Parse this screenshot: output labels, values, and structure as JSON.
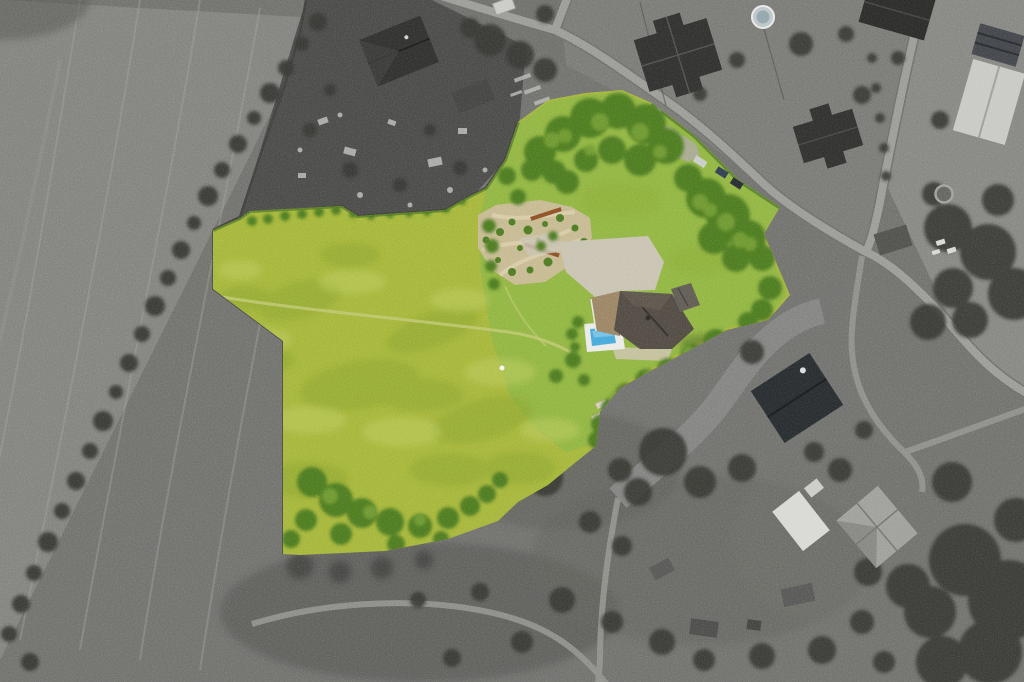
{
  "scene": {
    "type": "aerial-drone-photograph",
    "treatment": "property plot shown in color, all surroundings desaturated to grayscale",
    "subject": "rural residential plot with house, pool, gardens and large meadow"
  },
  "palette": {
    "base_gray": "#6c6c69",
    "field_gray_light": "#7e7e7a",
    "yard_gray_dark": "#454543",
    "plots_gray": "#757571",
    "right_gray": "#82827e",
    "allotment_gray": "#6a6a67",
    "tree_gray": "#30302e",
    "road_gray": "#989893",
    "road_casing": "#6a6a66",
    "track_gray": "#8f8f8a",
    "swath_gray": "#828280",
    "wall_gray": "#3a3a38",
    "fence_gray": "#50504c",
    "building_dark": "#2b2b29",
    "building_mid": "#4b4b47",
    "building_light": "#c6c6c2",
    "white_structure": "#d6d6d2",
    "rubble_light": "#b8b8b4",
    "meadow_green": "#a2b335",
    "lawn_green": "#8db23c",
    "mottle_dark_green": "#87a02b",
    "mottle_light_green": "#bcc95a",
    "tree_green": "#47761f",
    "tree_green_light": "#6f9a2d",
    "hedge_green": "#3f6b1c",
    "gravel_tan": "#c8b795",
    "patio_stone": "#c6c0ae",
    "terrace_tan": "#cabfa8",
    "rust_brown": "#8a4a20",
    "roof_main_dark": "#4c453e",
    "roof_ridge": "#2f2a26",
    "roof_wing_brown": "#97805f",
    "roof_garage": "#5b564e",
    "pool_blue": "#41a6d9",
    "pool_blue_light": "#7cc4e8",
    "pool_deck": "#e9e9e5",
    "van_white": "#f2f2f0",
    "car_silver": "#c7c9c6",
    "car_dark_blue": "#2c3a4e",
    "car_dark": "#23272c",
    "path_light": "#bcc56c",
    "bed_light": "#d8cfc0",
    "shadow_green": "#2f3a18"
  },
  "scatter": {
    "gray_treeline": [
      [
        318,
        22,
        9
      ],
      [
        302,
        44,
        7
      ],
      [
        286,
        68,
        8
      ],
      [
        270,
        93,
        10
      ],
      [
        254,
        118,
        7
      ],
      [
        238,
        144,
        9
      ],
      [
        222,
        170,
        8
      ],
      [
        208,
        196,
        10
      ],
      [
        194,
        223,
        7
      ],
      [
        181,
        250,
        9
      ],
      [
        168,
        278,
        8
      ],
      [
        155,
        306,
        10
      ],
      [
        142,
        334,
        8
      ],
      [
        129,
        363,
        9
      ],
      [
        116,
        392,
        7
      ],
      [
        103,
        421,
        10
      ],
      [
        90,
        451,
        8
      ],
      [
        76,
        481,
        9
      ],
      [
        62,
        511,
        8
      ],
      [
        48,
        542,
        10
      ],
      [
        34,
        573,
        8
      ],
      [
        21,
        604,
        9
      ],
      [
        9,
        634,
        8
      ],
      [
        30,
        662,
        9
      ]
    ],
    "gray_trees": [
      [
        545,
        14,
        9
      ],
      [
        700,
        94,
        7
      ],
      [
        737,
        60,
        8
      ],
      [
        846,
        34,
        8
      ],
      [
        862,
        95,
        9
      ],
      [
        898,
        58,
        7
      ],
      [
        940,
        120,
        9
      ],
      [
        801,
        44,
        12
      ],
      [
        490,
        40,
        16
      ],
      [
        520,
        55,
        14
      ],
      [
        545,
        70,
        12
      ],
      [
        470,
        28,
        10
      ],
      [
        948,
        228,
        24
      ],
      [
        988,
        252,
        28
      ],
      [
        1014,
        294,
        26
      ],
      [
        953,
        288,
        20
      ],
      [
        928,
        322,
        18
      ],
      [
        998,
        200,
        16
      ],
      [
        934,
        194,
        12
      ],
      [
        970,
        320,
        18
      ],
      [
        752,
        352,
        12
      ],
      [
        663,
        452,
        24
      ],
      [
        545,
        478,
        18
      ],
      [
        700,
        482,
        16
      ],
      [
        742,
        468,
        14
      ],
      [
        638,
        492,
        14
      ],
      [
        620,
        470,
        12
      ],
      [
        590,
        522,
        11
      ],
      [
        622,
        546,
        10
      ],
      [
        562,
        600,
        13
      ],
      [
        612,
        622,
        11
      ],
      [
        662,
        642,
        13
      ],
      [
        704,
        660,
        11
      ],
      [
        762,
        656,
        13
      ],
      [
        822,
        650,
        14
      ],
      [
        862,
        622,
        12
      ],
      [
        884,
        662,
        11
      ],
      [
        480,
        592,
        9
      ],
      [
        522,
        642,
        11
      ],
      [
        452,
        658,
        9
      ],
      [
        418,
        600,
        8
      ],
      [
        840,
        470,
        12
      ],
      [
        814,
        452,
        10
      ],
      [
        864,
        430,
        9
      ],
      [
        965,
        560,
        36
      ],
      [
        1008,
        600,
        40
      ],
      [
        930,
        612,
        26
      ],
      [
        990,
        652,
        32
      ],
      [
        942,
        662,
        26
      ],
      [
        1016,
        520,
        22
      ],
      [
        952,
        482,
        20
      ],
      [
        908,
        586,
        22
      ],
      [
        868,
        572,
        14
      ],
      [
        872,
        58,
        5
      ],
      [
        876,
        88,
        5
      ],
      [
        880,
        118,
        5
      ],
      [
        884,
        148,
        5
      ],
      [
        886,
        176,
        5
      ],
      [
        310,
        130,
        7
      ],
      [
        350,
        170,
        8
      ],
      [
        400,
        185,
        7
      ],
      [
        430,
        130,
        6
      ],
      [
        460,
        168,
        7
      ],
      [
        330,
        90,
        6
      ]
    ],
    "green_trees": [
      [
        540,
        152,
        16
      ],
      [
        563,
        134,
        18
      ],
      [
        590,
        118,
        20
      ],
      [
        618,
        111,
        18
      ],
      [
        646,
        124,
        20
      ],
      [
        666,
        146,
        18
      ],
      [
        640,
        160,
        16
      ],
      [
        612,
        150,
        14
      ],
      [
        586,
        160,
        12
      ],
      [
        532,
        170,
        11
      ],
      [
        554,
        172,
        12
      ],
      [
        688,
        178,
        14
      ],
      [
        706,
        198,
        20
      ],
      [
        728,
        216,
        22
      ],
      [
        748,
        238,
        18
      ],
      [
        762,
        258,
        13
      ],
      [
        714,
        238,
        16
      ],
      [
        736,
        258,
        14
      ],
      [
        770,
        288,
        12
      ],
      [
        762,
        310,
        11
      ],
      [
        748,
        322,
        10
      ],
      [
        567,
        182,
        12
      ],
      [
        507,
        176,
        9
      ],
      [
        518,
        197,
        8
      ],
      [
        489,
        226,
        7
      ],
      [
        492,
        246,
        7
      ],
      [
        491,
        266,
        6
      ],
      [
        494,
        284,
        6
      ],
      [
        252,
        221,
        5
      ],
      [
        268,
        219,
        5
      ],
      [
        285,
        216,
        5
      ],
      [
        302,
        214,
        5
      ],
      [
        319,
        212,
        5
      ],
      [
        336,
        210,
        5
      ],
      [
        353,
        214,
        4
      ],
      [
        371,
        216,
        4
      ],
      [
        390,
        214,
        4
      ],
      [
        409,
        213,
        4
      ],
      [
        427,
        212,
        4
      ],
      [
        446,
        209,
        4
      ],
      [
        462,
        201,
        4
      ],
      [
        716,
        342,
        13
      ],
      [
        692,
        356,
        12
      ],
      [
        668,
        369,
        11
      ],
      [
        646,
        380,
        11
      ],
      [
        626,
        394,
        11
      ],
      [
        611,
        408,
        10
      ],
      [
        601,
        424,
        10
      ],
      [
        597,
        440,
        9
      ],
      [
        312,
        482,
        15
      ],
      [
        336,
        500,
        17
      ],
      [
        362,
        513,
        15
      ],
      [
        390,
        522,
        14
      ],
      [
        420,
        526,
        12
      ],
      [
        448,
        518,
        11
      ],
      [
        470,
        506,
        10
      ],
      [
        487,
        494,
        9
      ],
      [
        306,
        520,
        11
      ],
      [
        291,
        539,
        9
      ],
      [
        341,
        534,
        11
      ],
      [
        396,
        544,
        9
      ],
      [
        441,
        539,
        8
      ],
      [
        500,
        480,
        8
      ],
      [
        573,
        360,
        8
      ],
      [
        556,
        376,
        7
      ],
      [
        584,
        380,
        6
      ],
      [
        578,
        322,
        6
      ],
      [
        572,
        334,
        6
      ],
      [
        575,
        347,
        5
      ],
      [
        553,
        236,
        5
      ],
      [
        541,
        246,
        5
      ]
    ],
    "green_trees_light": [
      [
        552,
        140,
        8
      ],
      [
        600,
        122,
        9
      ],
      [
        640,
        132,
        9
      ],
      [
        660,
        152,
        7
      ],
      [
        700,
        202,
        8
      ],
      [
        726,
        222,
        9
      ],
      [
        750,
        244,
        7
      ],
      [
        330,
        496,
        8
      ],
      [
        370,
        512,
        7
      ],
      [
        420,
        520,
        6
      ],
      [
        688,
        352,
        6
      ],
      [
        650,
        376,
        6
      ],
      [
        615,
        398,
        6
      ],
      [
        565,
        136,
        7
      ],
      [
        590,
        150,
        6
      ],
      [
        740,
        240,
        8
      ],
      [
        710,
        210,
        7
      ]
    ]
  }
}
